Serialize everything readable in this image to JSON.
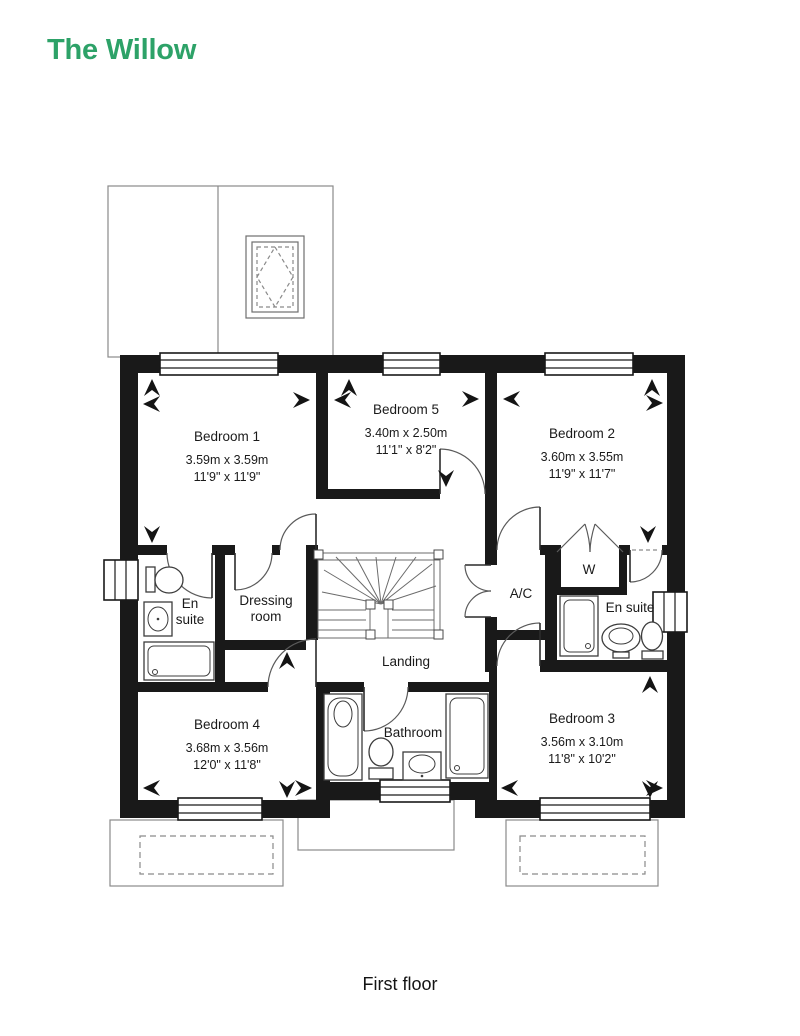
{
  "title": {
    "text": "The Willow",
    "color": "#2DA268"
  },
  "caption": "First floor",
  "floorplan": {
    "rooms": {
      "bedroom1": {
        "name": "Bedroom 1",
        "metric": "3.59m x 3.59m",
        "imperial": "11'9\" x 11'9\""
      },
      "bedroom5": {
        "name": "Bedroom 5",
        "metric": "3.40m x 2.50m",
        "imperial": "11'1\" x 8'2\""
      },
      "bedroom2": {
        "name": "Bedroom 2",
        "metric": "3.60m x 3.55m",
        "imperial": "11'9\" x 11'7\""
      },
      "bedroom4": {
        "name": "Bedroom 4",
        "metric": "3.68m x 3.56m",
        "imperial": "12'0\" x 11'8\""
      },
      "bedroom3": {
        "name": "Bedroom 3",
        "metric": "3.56m x 3.10m",
        "imperial": "11'8\" x 10'2\""
      },
      "ensuite_left": {
        "line1": "En",
        "line2": "suite"
      },
      "dressing_room": {
        "line1": "Dressing",
        "line2": "room"
      },
      "wardrobe": {
        "name": "W"
      },
      "airing_cupboard": {
        "name": "A/C"
      },
      "ensuite_right": {
        "name": "En suite"
      },
      "landing": {
        "name": "Landing"
      },
      "bathroom": {
        "name": "Bathroom"
      }
    }
  }
}
